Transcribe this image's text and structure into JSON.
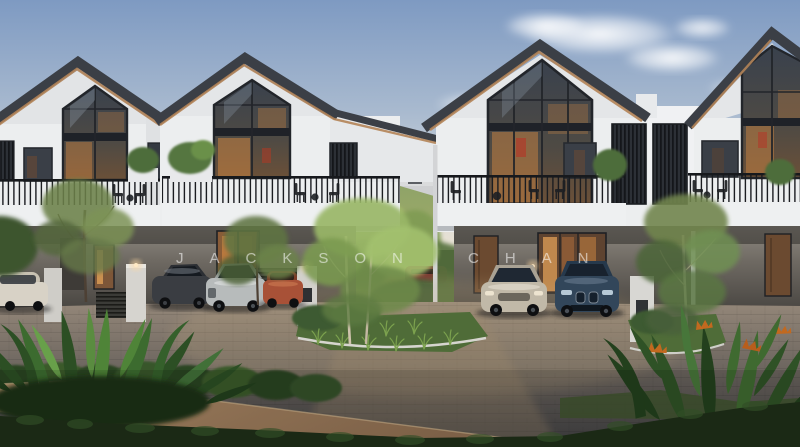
{
  "image": {
    "kind": "architectural exterior rendering",
    "subject": "Row of modern two-storey gabled houses at dusk with warm interior lighting, parked cars, courtyard garden and tropical landscaping",
    "time_of_day": "dusk",
    "width": 800,
    "height": 447
  },
  "watermark": {
    "text": "JACKSON CHAN",
    "color": "#FFFFFF",
    "opacity": 0.55
  },
  "scene": {
    "houses": [
      {
        "id": "house-1",
        "label": "left house",
        "features": "gabled roof, two-storey glass gable window, balcony with black railing, carport"
      },
      {
        "id": "house-2",
        "label": "centre-left house",
        "features": "gabled roof, tall amber-lit glass gable, balcony chairs, lit entry door"
      },
      {
        "id": "house-3",
        "label": "centre-right house",
        "features": "gabled roof, full-height glazing, balcony lounge set, louvred screens, carport"
      },
      {
        "id": "house-4",
        "label": "right house",
        "features": "gabled roof, glass gable, balcony, timber door, carport"
      },
      {
        "id": "house-5",
        "label": "small distant house in courtyard gap"
      }
    ],
    "vehicles": [
      {
        "id": "car-white",
        "description": "white sedan at left edge",
        "color": "#D8D2C6"
      },
      {
        "id": "car-grey",
        "description": "dark grey sedan in left carport",
        "color": "#3A3D42"
      },
      {
        "id": "car-silver",
        "description": "silver sedan in left carport",
        "color": "#B7BBBB"
      },
      {
        "id": "car-copper",
        "description": "copper-orange car in left carport",
        "color": "#A85137"
      },
      {
        "id": "car-maroon",
        "description": "maroon car in rear courtyard",
        "color": "#7B3A32"
      },
      {
        "id": "car-champagne",
        "description": "champagne sedan in right carport",
        "color": "#C1B9A8"
      },
      {
        "id": "car-navy",
        "description": "dark blue SUV in right carport",
        "color": "#32465A"
      }
    ],
    "vegetation": "foreground tropical plants, street hedge, courtyard trees, balcony planters, bird-of-paradise flowers",
    "lighting": "low dusk sun, amber interior lights, pillar lamps lit"
  },
  "palette": {
    "sky_top": "#7E9AC2",
    "sky_mid": "#A9BACF",
    "sky_low": "#D2D8DC",
    "sky_horizon": "#EAE2D3",
    "cloud": "#FFFFFF",
    "roof": "#3B3F46",
    "soffit_wood": "#B28357",
    "wall": "#ECEEEF",
    "wall_shade": "#E0E2E4",
    "frame": "#22252A",
    "glass_cool": "#38424E",
    "glow_amber": "#C98342",
    "balcony": "#EEF0F1",
    "lower_wall": "#8B857C",
    "lower_dark": "#45423E",
    "railing": "#1B1D21",
    "pave_light": "#948779",
    "pave_dark": "#3F3F41",
    "sidewalk": "#B4916C",
    "grass": "#4F6C38",
    "hedge": "#1F2F19",
    "leaf_dark": "#28471F",
    "leaf_mid": "#3F6A2F",
    "leaf_light": "#6DA04B",
    "tree_bright": "#9AB768",
    "tree_olive": "#71854D",
    "trunk": "#CDC2AE",
    "flower_orange": "#C2691F"
  }
}
